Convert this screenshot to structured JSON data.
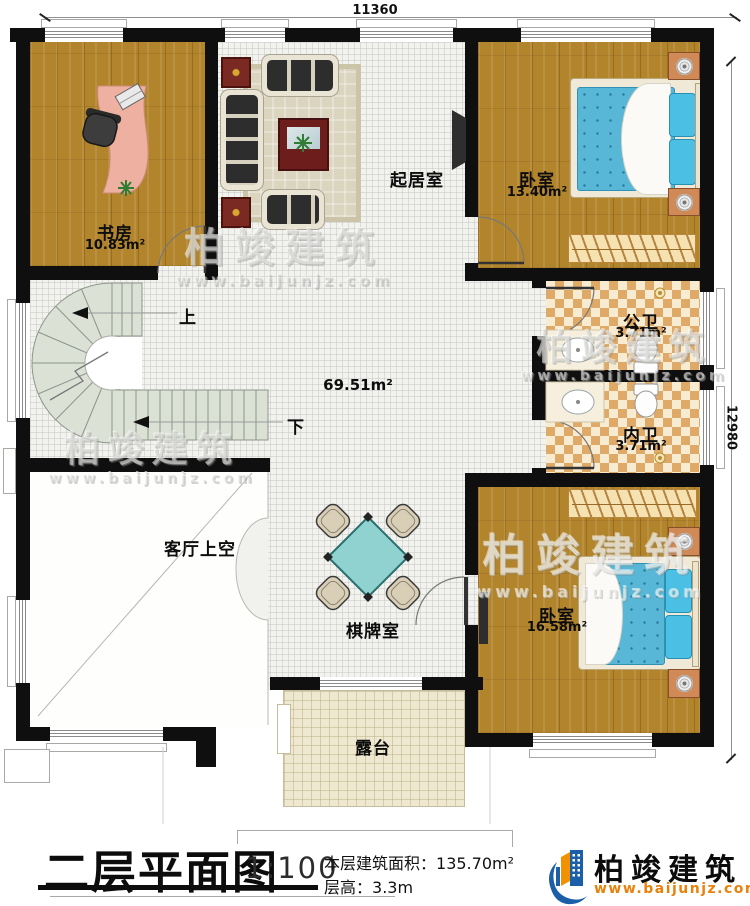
{
  "dimensions": {
    "top": "11360",
    "right": "12980"
  },
  "rooms": {
    "study": {
      "name": "书房",
      "area": "10.83m²"
    },
    "living": {
      "name": "起居室"
    },
    "bedroom_top": {
      "name": "卧室",
      "area": "13.40m²"
    },
    "bath_public": {
      "name": "公卫",
      "area": "3.71m²"
    },
    "bath_private": {
      "name": "内卫",
      "area": "3.71m²"
    },
    "bedroom_bottom": {
      "name": "卧室",
      "area": "16.58m²"
    },
    "void_above_living": {
      "name": "客厅上空"
    },
    "chess_room": {
      "name": "棋牌室"
    },
    "terrace": {
      "name": "露台"
    },
    "hall": {
      "area": "69.51m²"
    }
  },
  "stairs": {
    "up_label": "上",
    "down_label": "下"
  },
  "watermark": {
    "brand": "柏竣建筑",
    "url": "www.baijunjz.com"
  },
  "title_block": {
    "title": "二层平面图",
    "scale": "1:100",
    "area_label": "本层建筑面积：",
    "area_value": "135.70m²",
    "height_label": "层高：",
    "height_value": "3.3m",
    "brand": "柏竣建筑",
    "brand_url": "www.baijunjz.com"
  },
  "colors": {
    "wall": "#0f0f0f",
    "wood": "#b2852d",
    "tile_dark": "#dfa968",
    "tile_light": "#f7ecd2",
    "stair": "#dce1d6",
    "terrace": "#eee8d0",
    "bed_blue": "#58b7d7",
    "brand_blue": "#1a5fa8",
    "brand_orange": "#f29200"
  }
}
